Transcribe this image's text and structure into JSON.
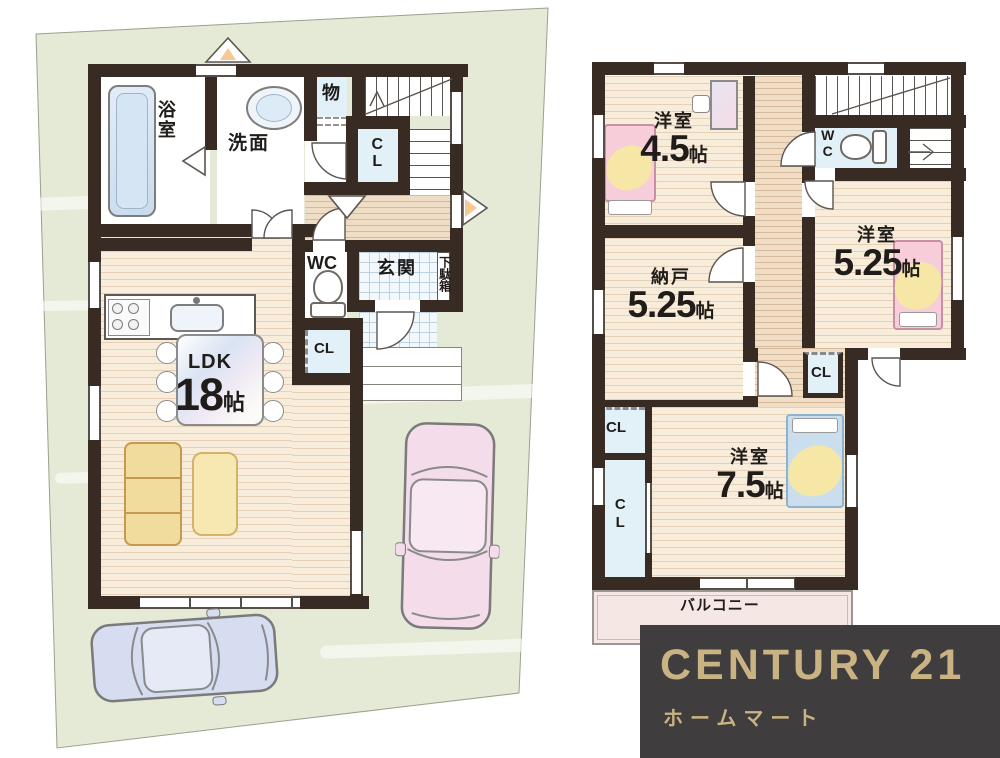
{
  "colors": {
    "site_green": "#e4ead6",
    "wall": "#382b24",
    "wood_floor": "#f8ecdb",
    "closet_blue": "#e2f0f7",
    "logo_background": "#403d3f",
    "logo_gold": "#c9b383"
  },
  "floor1": {
    "bath": "浴室",
    "washroom": "洗面",
    "storage": "物",
    "stair_closet": "CL",
    "wc": "WC",
    "entrance": "玄関",
    "shoe_cabinet": "下駄箱",
    "living_closet": "CL",
    "ldk_name": "LDK",
    "ldk_size": "18",
    "ldk_unit": "帖"
  },
  "floor2": {
    "bedroom_small_name": "洋室",
    "bedroom_small_size": "4.5",
    "bedroom_small_unit": "帖",
    "wc": "WC",
    "bedroom_mid_name": "洋室",
    "bedroom_mid_size": "5.25",
    "bedroom_mid_unit": "帖",
    "storeroom_name": "納戸",
    "storeroom_size": "5.25",
    "storeroom_unit": "帖",
    "closet_a": "CL",
    "closet_b": "CL",
    "closet_c": "CL",
    "bedroom_large_name": "洋室",
    "bedroom_large_size": "7.5",
    "bedroom_large_unit": "帖",
    "balcony": "バルコニー"
  },
  "logo": {
    "brand": "CENTURY 21",
    "company": "ホームマート"
  }
}
